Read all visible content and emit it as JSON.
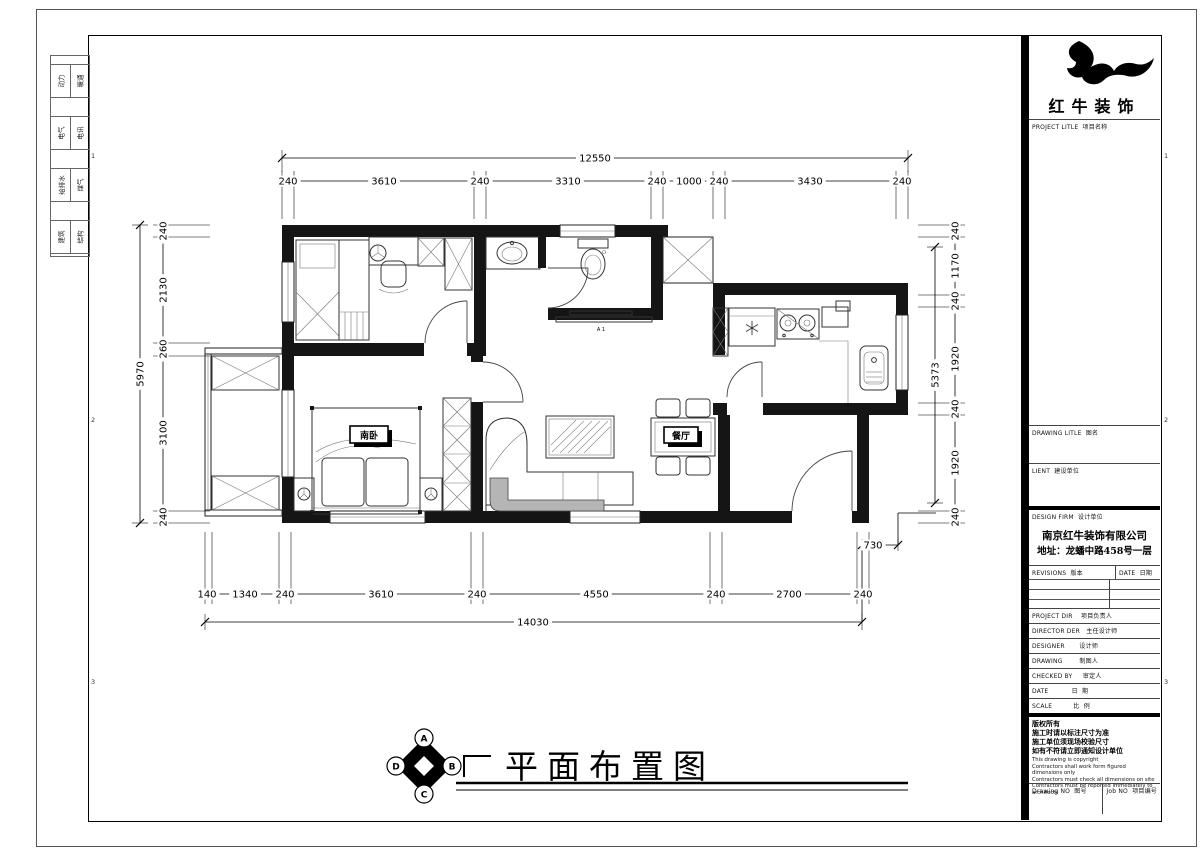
{
  "sheet": {
    "frame": {
      "marks": [
        "1",
        "2",
        "3"
      ]
    },
    "margin_disciplines": [
      {
        "a": "动力",
        "b": "暖通"
      },
      {
        "a": "电气",
        "b": "电讯"
      },
      {
        "a": "给排水",
        "b": "煤气"
      },
      {
        "a": "建筑",
        "b": "结构"
      }
    ]
  },
  "title_block": {
    "brand_name": "红牛装饰",
    "rows": {
      "project_title": "PROJECT LITLE  项目名称",
      "drawing_title": "DRAWING LITLE  图名",
      "client": "LIENT  建设单位",
      "design_firm": "DESIGN FIRM  设计单位",
      "company_name": "南京红牛装饰有限公司",
      "company_address": "地址：龙蟠中路458号一层",
      "revisions": "REVISIONS  版本",
      "date_col": "DATE  日期",
      "project_dir": "PROJECT DIR    项目负责人",
      "director": "DIRECTOR DER   主任设计师",
      "designer": "DESIGNER       设计师",
      "drawing": "DRAWING        制图人",
      "checked_by": "CHECKED BY     审定人",
      "date": "DATE           日  期",
      "scale": "SCALE          比  例",
      "drawing_no": "Drawing NO  图号",
      "job_no": "Job NO  项目编号"
    },
    "copyright_cn": [
      "版权所有",
      "施工时请以标注尺寸为准",
      "施工单位须现场校验尺寸",
      "如有不符请立即通知设计单位"
    ],
    "copyright_en": [
      "This drawing is copyright",
      "Contractors shall work form figured dimensions only",
      "Contractors must check all dimensions on site",
      "Contractors must be reported immediately to architects"
    ]
  },
  "drawing": {
    "title": "平面布置图",
    "compass": {
      "top": "A",
      "right": "B",
      "bottom": "C",
      "left": "D"
    },
    "rooms": {
      "master_bedroom": "南卧",
      "dining": "餐厅",
      "tv_mark": "A 1"
    },
    "dimensions": [
      {
        "dir": "h",
        "pos": 158,
        "e1": -8,
        "e2": 14,
        "ticks": [
          282,
          908
        ],
        "labels": [
          {
            "t": "12550",
            "c": 595
          }
        ]
      },
      {
        "dir": "h",
        "pos": 181,
        "e1": -10,
        "e2": 38,
        "ticks": [
          282,
          294,
          474,
          486,
          651,
          663,
          713,
          725,
          896,
          908
        ],
        "labels": [
          {
            "t": "240",
            "c": 288
          },
          {
            "t": "3610",
            "c": 384
          },
          {
            "t": "240",
            "c": 480
          },
          {
            "t": "3310",
            "c": 568
          },
          {
            "t": "240",
            "c": 657
          },
          {
            "t": "1000",
            "c": 689
          },
          {
            "t": "240",
            "c": 719
          },
          {
            "t": "3430",
            "c": 810
          },
          {
            "t": "240",
            "c": 902
          }
        ]
      },
      {
        "dir": "h",
        "pos": 594,
        "e1": -62,
        "e2": 10,
        "ticks": [
          205,
          212,
          279,
          291,
          471,
          483,
          710,
          722,
          857,
          869
        ],
        "labels": [
          {
            "t": "140",
            "c": 207
          },
          {
            "t": "1340",
            "c": 245
          },
          {
            "t": "240",
            "c": 285
          },
          {
            "t": "3610",
            "c": 381
          },
          {
            "t": "240",
            "c": 477
          },
          {
            "t": "4550",
            "c": 596
          },
          {
            "t": "240",
            "c": 716
          },
          {
            "t": "2700",
            "c": 789
          },
          {
            "t": "240",
            "c": 863
          }
        ]
      },
      {
        "dir": "h",
        "pos": 622,
        "e1": -8,
        "e2": 8,
        "ticks": [
          205,
          862
        ],
        "labels": [
          {
            "t": "14030",
            "c": 533
          }
        ]
      },
      {
        "dir": "v",
        "pos": 163,
        "e1": -10,
        "e2": 47,
        "ticks": [
          225,
          237,
          343,
          356,
          511,
          523
        ],
        "labels": [
          {
            "t": "240",
            "c": 231
          },
          {
            "t": "2130",
            "c": 290
          },
          {
            "t": "260",
            "c": 349
          },
          {
            "t": "3100",
            "c": 433
          },
          {
            "t": "240",
            "c": 517
          }
        ]
      },
      {
        "dir": "v",
        "pos": 140,
        "e1": -8,
        "e2": 8,
        "ticks": [
          225,
          523
        ],
        "labels": [
          {
            "t": "5970",
            "c": 374
          }
        ]
      },
      {
        "dir": "v",
        "pos": 955,
        "e1": -37,
        "e2": 10,
        "ticks": [
          225,
          237,
          295,
          307,
          403,
          415,
          511,
          523
        ],
        "labels": [
          {
            "t": "240",
            "c": 231
          },
          {
            "t": "1170",
            "c": 266
          },
          {
            "t": "240",
            "c": 301
          },
          {
            "t": "1920",
            "c": 359
          },
          {
            "t": "240",
            "c": 409
          },
          {
            "t": "1920",
            "c": 463
          },
          {
            "t": "240",
            "c": 517
          }
        ]
      },
      {
        "dir": "v",
        "pos": 935,
        "e1": -8,
        "e2": 8,
        "ticks": [
          247,
          503
        ],
        "labels": [
          {
            "t": "5373",
            "c": 375
          }
        ]
      },
      {
        "dir": "h",
        "pos": 545,
        "e1": -6,
        "e2": 6,
        "ticks": [
          862,
          898
        ],
        "labels": [
          {
            "t": "730",
            "c": 873
          }
        ]
      }
    ]
  }
}
